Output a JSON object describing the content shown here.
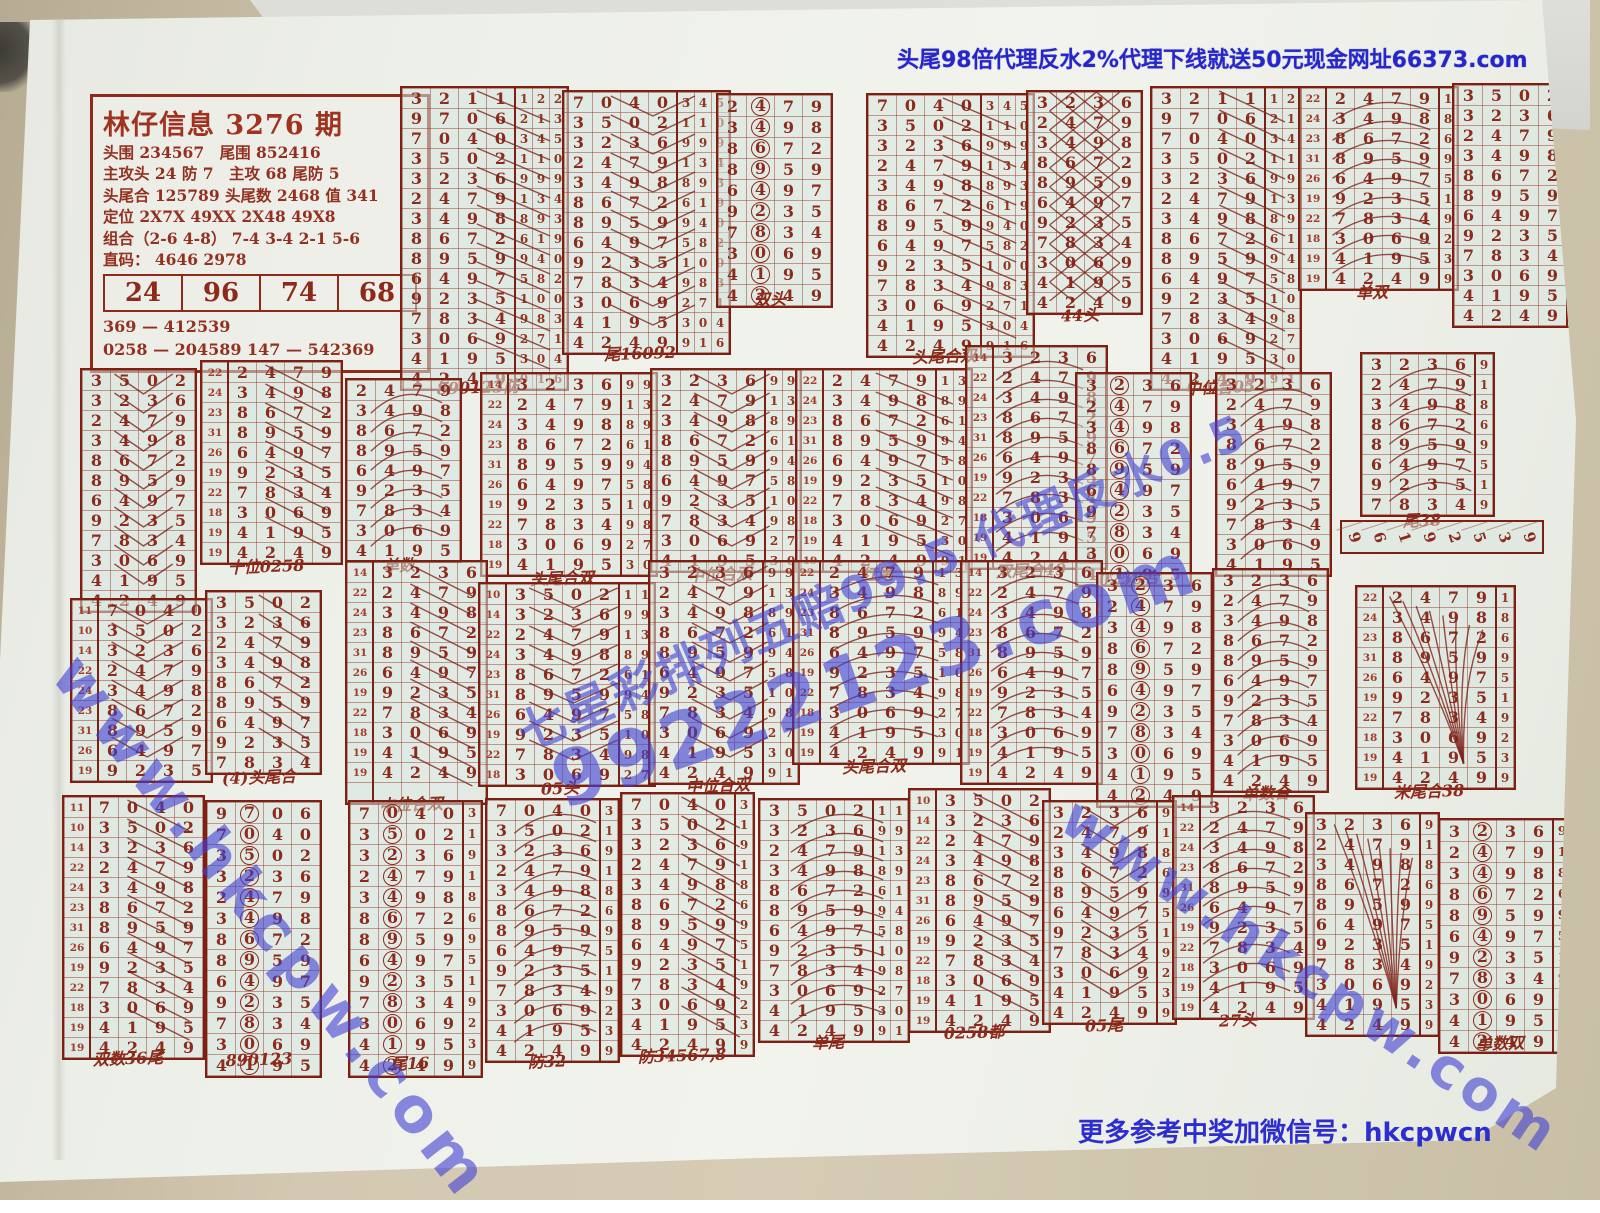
{
  "photo": {
    "desk_color": "#cfc5ae",
    "paper_color": "#eef0ea",
    "grid_tint": "#d5e5de",
    "ink_color": "#8c2a1b",
    "frame_color": "#7c2014",
    "blue_text_color": "#2626cb",
    "watermark_color": "#4040d2"
  },
  "top_ad": "头尾98倍代理反水2%代理下线就送50元现金网址66373.com",
  "bottom_note": "更多参考中奖加微信号：hkcpwcn",
  "watermarks": [
    {
      "text": "www.hkcpw.com"
    },
    {
      "text": "99222123.com"
    },
    {
      "text": "七星彩排列五赔99.5 代理反水0.5"
    },
    {
      "text": "www.hkcpw.com"
    }
  ],
  "info_box": {
    "title": "林仔信息 3276 期",
    "lines": [
      "头围 234567　尾围 852416",
      "主攻头 24 防 7　主攻 68 尾防 5",
      "头尾合 125789 头尾数 2468 值 341",
      "定位 2X7X 49XX 2X48 49X8",
      "组合（2-6 4-8） 7-4 3-4 2-1 5-6",
      "直码： 4646 2978"
    ],
    "table": [
      "24",
      "96",
      "74",
      "68"
    ],
    "footers": [
      "369 — 412539",
      "0258 — 204589  147 — 542369"
    ]
  },
  "sequence": {
    "rows": [
      "3211",
      "9706",
      "7040",
      "3502",
      "3236",
      "2479",
      "3498",
      "8672",
      "8959",
      "6497",
      "9235",
      "7834",
      "3069",
      "4195",
      "4249"
    ],
    "leaders": [
      "",
      "",
      "11",
      "10",
      "14",
      "22",
      "24",
      "23",
      "31",
      "26",
      "19",
      "22",
      "18",
      "19",
      "19"
    ],
    "extras": [
      "122",
      "213",
      "345",
      "110",
      "999",
      "134",
      "893",
      "619",
      "940",
      "582",
      "100",
      "983",
      "271",
      "304",
      "916"
    ]
  },
  "strip": {
    "x": 1340,
    "y": 520,
    "digits": "96192539"
  },
  "blocks": [
    {
      "x": 400,
      "y": 86,
      "s": 0,
      "c": 15,
      "ld": false,
      "ex": 3,
      "an": "slash",
      "lb": "890123防"
    },
    {
      "x": 562,
      "y": 90,
      "s": 2,
      "c": 13,
      "ld": false,
      "ex": 3,
      "an": "chevron",
      "lb": "尾16092"
    },
    {
      "x": 716,
      "y": 93,
      "s": 5,
      "c": 10,
      "ld": false,
      "ex": 0,
      "an": "circle",
      "lb": "双头"
    },
    {
      "x": 866,
      "y": 93,
      "s": 2,
      "c": 13,
      "ld": false,
      "ex": 3,
      "an": "slash",
      "lb": "头尾合双"
    },
    {
      "x": 1026,
      "y": 90,
      "s": 4,
      "c": 11,
      "ld": false,
      "ex": 0,
      "an": "cross",
      "lb": "44头"
    },
    {
      "x": 1150,
      "y": 86,
      "s": 0,
      "c": 15,
      "ld": false,
      "ex": 2,
      "an": "slash",
      "lb": "中位合05"
    },
    {
      "x": 1298,
      "y": 86,
      "s": 5,
      "c": 10,
      "ld": true,
      "ex": 1,
      "an": "arc",
      "lb": "单双"
    },
    {
      "x": 1452,
      "y": 83,
      "s": 3,
      "c": 12,
      "ld": false,
      "ex": 1,
      "an": "none",
      "lb": ""
    },
    {
      "x": 80,
      "y": 368,
      "s": 3,
      "c": 12,
      "ld": false,
      "ex": 0,
      "an": "chevron",
      "lb": ""
    },
    {
      "x": 200,
      "y": 360,
      "s": 5,
      "c": 10,
      "ld": true,
      "ex": 0,
      "an": "slash",
      "lb": "十位0258"
    },
    {
      "x": 345,
      "y": 378,
      "s": 5,
      "c": 9,
      "ld": false,
      "ex": 0,
      "an": "arc",
      "lb": "单数"
    },
    {
      "x": 480,
      "y": 372,
      "s": 4,
      "c": 10,
      "ld": true,
      "ex": 2,
      "an": "none",
      "lb": "头尾合双"
    },
    {
      "x": 650,
      "y": 368,
      "s": 4,
      "c": 10,
      "ld": false,
      "ex": 2,
      "an": "chevron",
      "lb": "中位合双"
    },
    {
      "x": 795,
      "y": 368,
      "s": 5,
      "c": 10,
      "ld": true,
      "ex": 2,
      "an": "slash",
      "lb": "红尾"
    },
    {
      "x": 965,
      "y": 345,
      "s": 4,
      "c": 11,
      "ld": true,
      "ex": 0,
      "an": "arc",
      "lb": "双尾合49"
    },
    {
      "x": 1075,
      "y": 372,
      "s": 4,
      "c": 10,
      "ld": false,
      "ex": 0,
      "an": "circle",
      "lb": "0258合"
    },
    {
      "x": 1215,
      "y": 372,
      "s": 4,
      "c": 10,
      "ld": false,
      "ex": 0,
      "an": "arc",
      "lb": ""
    },
    {
      "x": 1360,
      "y": 352,
      "s": 4,
      "c": 8,
      "ld": false,
      "ex": 1,
      "an": "arc",
      "lb": "尾38"
    },
    {
      "x": 70,
      "y": 598,
      "s": 2,
      "c": 9,
      "ld": true,
      "ex": 0,
      "an": "chevron",
      "lb": ""
    },
    {
      "x": 205,
      "y": 590,
      "s": 3,
      "c": 9,
      "ld": false,
      "ex": 0,
      "an": "slash",
      "lb": "(4)头尾合"
    },
    {
      "x": 345,
      "y": 560,
      "s": 4,
      "c": 12,
      "ld": true,
      "ex": 0,
      "an": "slash",
      "lb": "中位合双"
    },
    {
      "x": 478,
      "y": 582,
      "s": 3,
      "c": 10,
      "ld": true,
      "ex": 2,
      "an": "chevron",
      "lb": "05头"
    },
    {
      "x": 648,
      "y": 560,
      "s": 4,
      "c": 11,
      "ld": false,
      "ex": 2,
      "an": "chevron",
      "lb": "中位合双"
    },
    {
      "x": 792,
      "y": 560,
      "s": 5,
      "c": 10,
      "ld": true,
      "ex": 2,
      "an": "arc",
      "lb": "头尾合双"
    },
    {
      "x": 960,
      "y": 560,
      "s": 4,
      "c": 11,
      "ld": true,
      "ex": 0,
      "an": "arc",
      "lb": ""
    },
    {
      "x": 1096,
      "y": 572,
      "s": 4,
      "c": 11,
      "ld": false,
      "ex": 0,
      "an": "circle",
      "lb": ""
    },
    {
      "x": 1212,
      "y": 568,
      "s": 4,
      "c": 11,
      "ld": false,
      "ex": 0,
      "an": "arc",
      "lb": "单数合"
    },
    {
      "x": 1355,
      "y": 585,
      "s": 5,
      "c": 10,
      "ld": true,
      "ex": 1,
      "an": "fan",
      "lb": "米尾合38"
    },
    {
      "x": 62,
      "y": 795,
      "s": 2,
      "c": 13,
      "ld": true,
      "ex": 0,
      "an": "slash",
      "lb": "双数36尾"
    },
    {
      "x": 205,
      "y": 800,
      "s": 1,
      "c": 13,
      "ld": false,
      "ex": 0,
      "an": "circle",
      "lb": "890123"
    },
    {
      "x": 348,
      "y": 800,
      "s": 2,
      "c": 13,
      "ld": false,
      "ex": 1,
      "an": "circle",
      "lb": "尾16"
    },
    {
      "x": 485,
      "y": 798,
      "s": 2,
      "c": 13,
      "ld": false,
      "ex": 1,
      "an": "arc",
      "lb": "防32"
    },
    {
      "x": 620,
      "y": 792,
      "s": 2,
      "c": 13,
      "ld": false,
      "ex": 1,
      "an": "slash",
      "lb": "防34567,8"
    },
    {
      "x": 758,
      "y": 798,
      "s": 3,
      "c": 12,
      "ld": false,
      "ex": 2,
      "an": "arc",
      "lb": "单尾"
    },
    {
      "x": 908,
      "y": 788,
      "s": 3,
      "c": 12,
      "ld": true,
      "ex": 0,
      "an": "slash",
      "lb": "0258都"
    },
    {
      "x": 1042,
      "y": 800,
      "s": 4,
      "c": 11,
      "ld": false,
      "ex": 1,
      "an": "chevron",
      "lb": "05尾"
    },
    {
      "x": 1172,
      "y": 795,
      "s": 4,
      "c": 11,
      "ld": true,
      "ex": 0,
      "an": "arc",
      "lb": "27头"
    },
    {
      "x": 1305,
      "y": 812,
      "s": 4,
      "c": 11,
      "ld": false,
      "ex": 1,
      "an": "fan",
      "lb": ""
    },
    {
      "x": 1438,
      "y": 818,
      "s": 4,
      "c": 11,
      "ld": false,
      "ex": 1,
      "an": "circle",
      "lb": "单数双"
    }
  ]
}
